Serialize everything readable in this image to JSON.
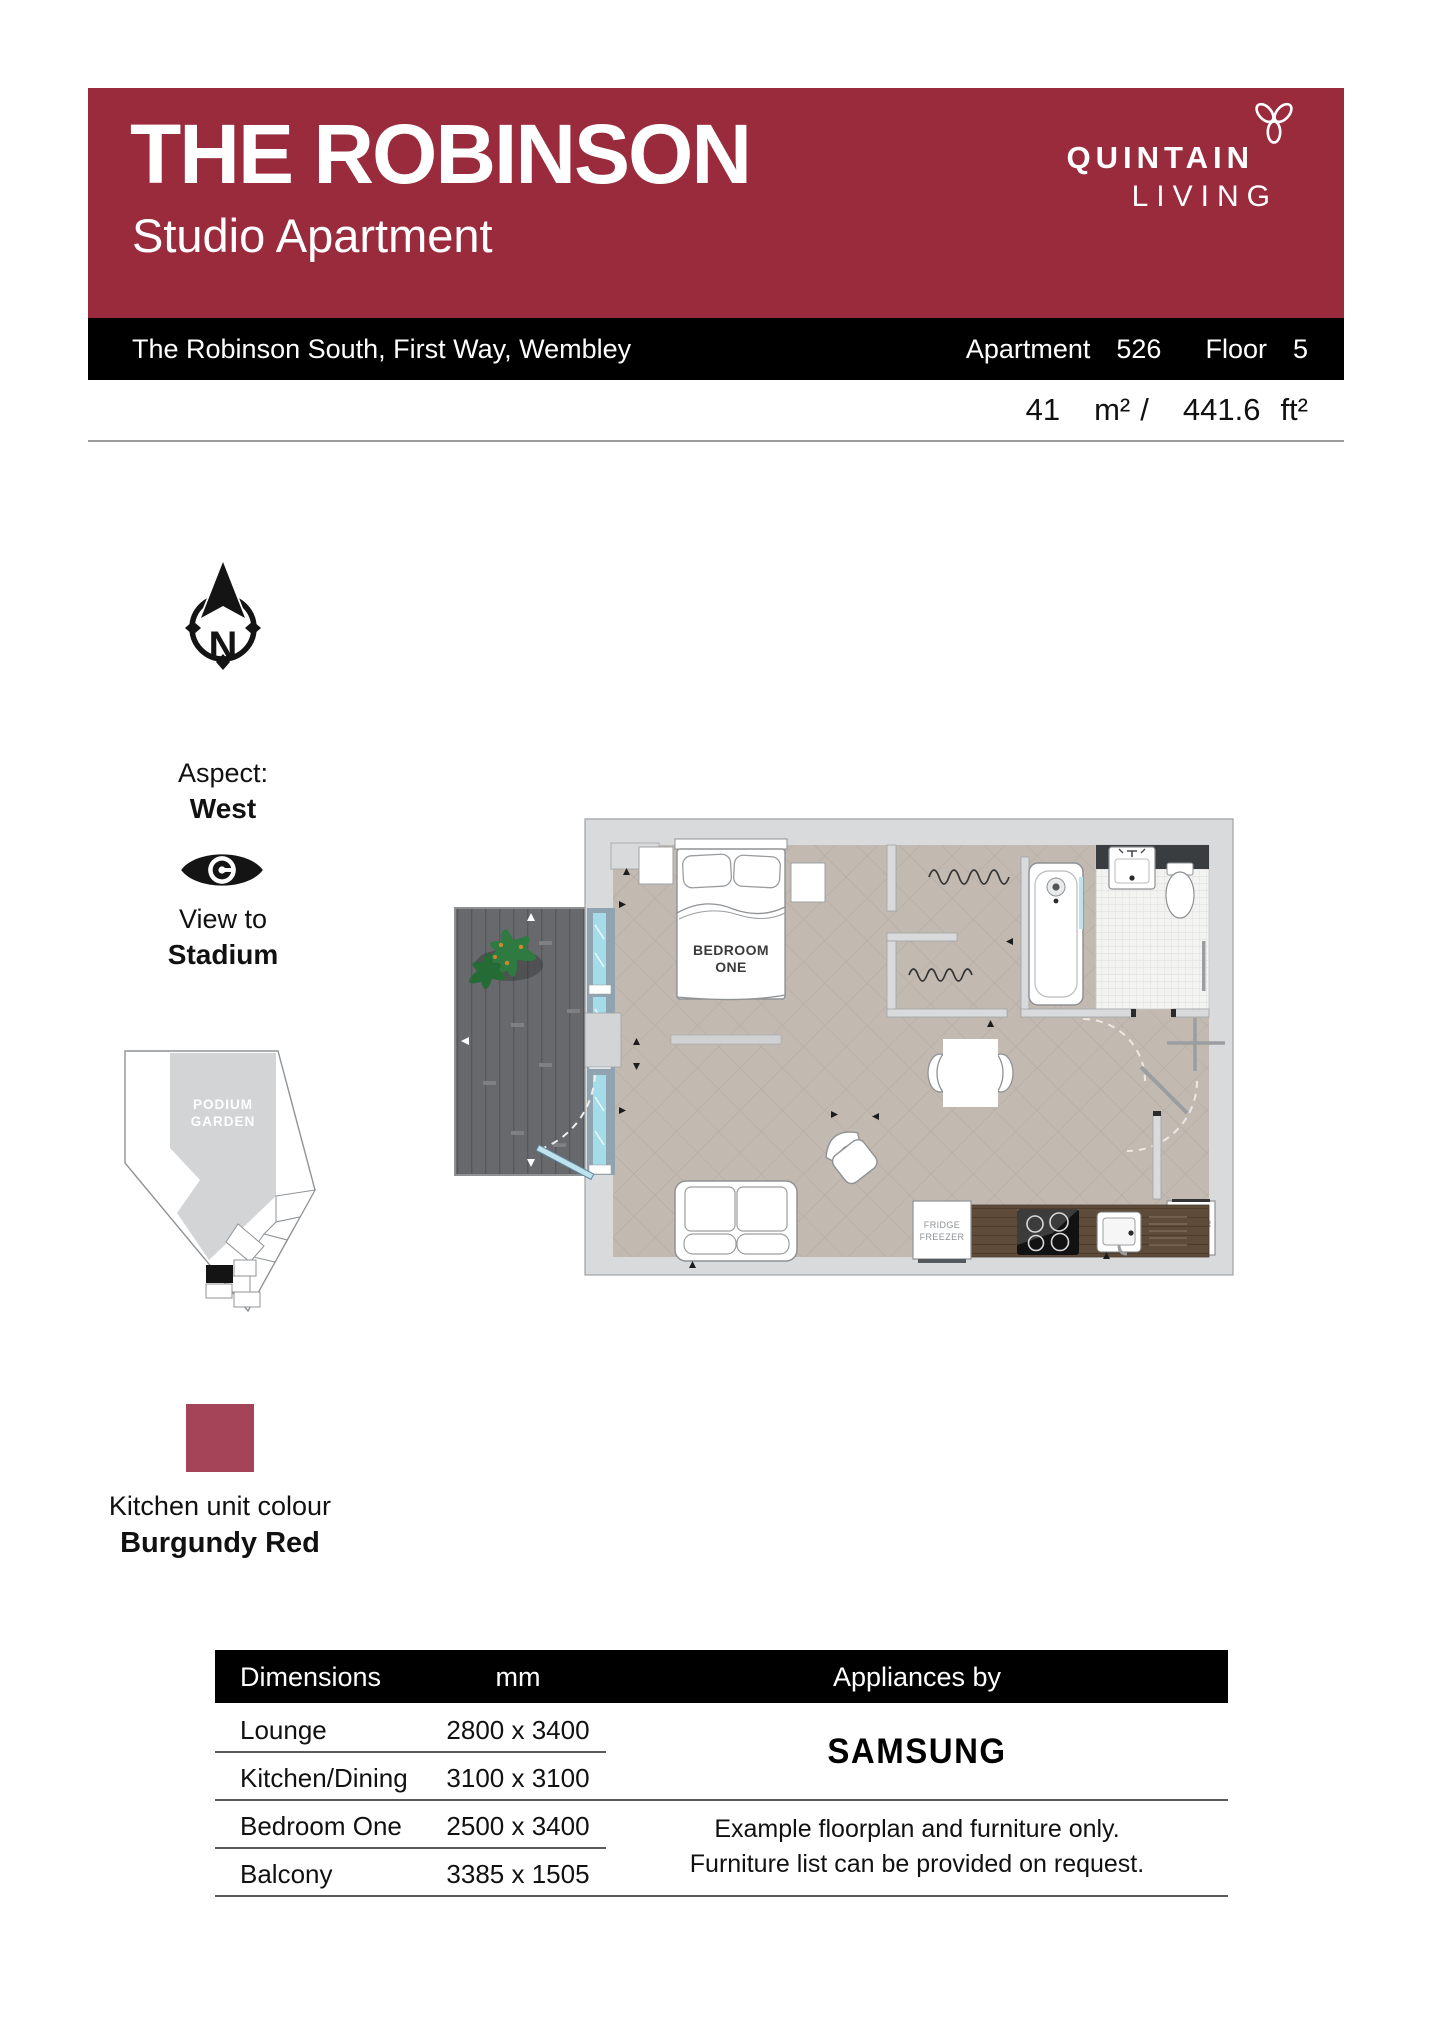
{
  "header": {
    "title": "THE ROBINSON",
    "subtitle": "Studio Apartment",
    "brand_line1": "QUINTAIN",
    "brand_line2": "LIVING"
  },
  "address_bar": {
    "address": "The Robinson South, First Way, Wembley",
    "apartment_label": "Apartment",
    "apartment_number": "526",
    "floor_label": "Floor",
    "floor_number": "5"
  },
  "area": {
    "metric_value": "41",
    "metric_unit": "m²",
    "separator": "/",
    "imperial_value": "441.6",
    "imperial_unit": "ft²"
  },
  "compass": {
    "letter": "N"
  },
  "aspect": {
    "label": "Aspect:",
    "value": "West"
  },
  "view": {
    "label": "View to",
    "value": "Stadium"
  },
  "site_plan": {
    "garden_label": [
      "PODIUM",
      "GARDEN"
    ]
  },
  "floorplan": {
    "bedroom_label": [
      "BEDROOM",
      "ONE"
    ],
    "fridge_label": [
      "FRIDGE",
      "FREEZER"
    ],
    "washer_label": [
      "WASHER",
      "DRYER"
    ]
  },
  "kitchen_colour": {
    "label": "Kitchen unit colour",
    "value": "Burgundy Red",
    "swatch_color": "#a54358"
  },
  "dimensions_table": {
    "headers": {
      "dimensions": "Dimensions",
      "unit": "mm",
      "appliances": "Appliances by"
    },
    "rows": [
      {
        "name": "Lounge",
        "size": "2800 x 3400"
      },
      {
        "name": "Kitchen/Dining",
        "size": "3100 x 3100"
      },
      {
        "name": "Bedroom One",
        "size": "2500 x 3400"
      },
      {
        "name": "Balcony",
        "size": "3385 x 1505"
      }
    ],
    "appliance_brand": "SAMSUNG",
    "note_line1": "Example floorplan and furniture only.",
    "note_line2": "Furniture list can be provided on request."
  },
  "colors": {
    "header_bg": "#9a2b3c",
    "swatch": "#a54358",
    "bar_bg": "#000000"
  },
  "icons": {
    "brand": "trillium-icon",
    "north": "compass-north-icon",
    "view": "eye-icon"
  }
}
